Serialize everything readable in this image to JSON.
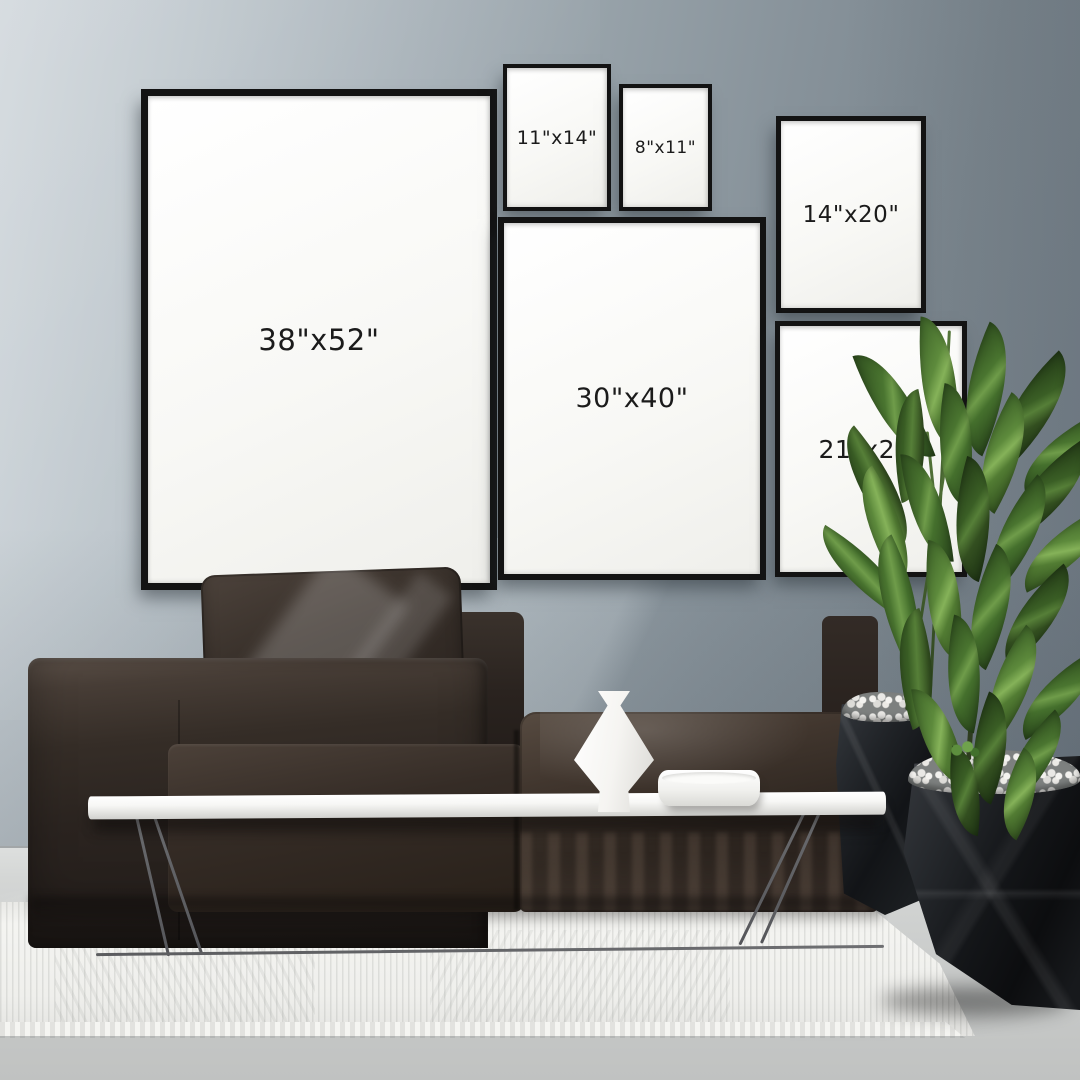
{
  "frames": [
    {
      "id": "38x52",
      "label": "38\"x52\""
    },
    {
      "id": "11x14",
      "label": "11\"x14\""
    },
    {
      "id": "8x11",
      "label": "8\"x11\""
    },
    {
      "id": "14x20",
      "label": "14\"x20\""
    },
    {
      "id": "30x40",
      "label": "30\"x40\""
    },
    {
      "id": "21x28",
      "label": "21\"x28\""
    }
  ],
  "palette": {
    "wall_light": "#ced5da",
    "wall_dark": "#75808a",
    "frame_border": "#131313",
    "mat_white": "#fafaf8",
    "label_text": "#1b1b1b",
    "sofa_dark": "#241e1b",
    "sofa_highlight": "#5a4f47",
    "rug_white": "#f1f1ee",
    "floor_gray": "#c9cbca",
    "table_white": "#fafafa",
    "plant_green": "#4a7530",
    "planter_black": "#141619"
  }
}
